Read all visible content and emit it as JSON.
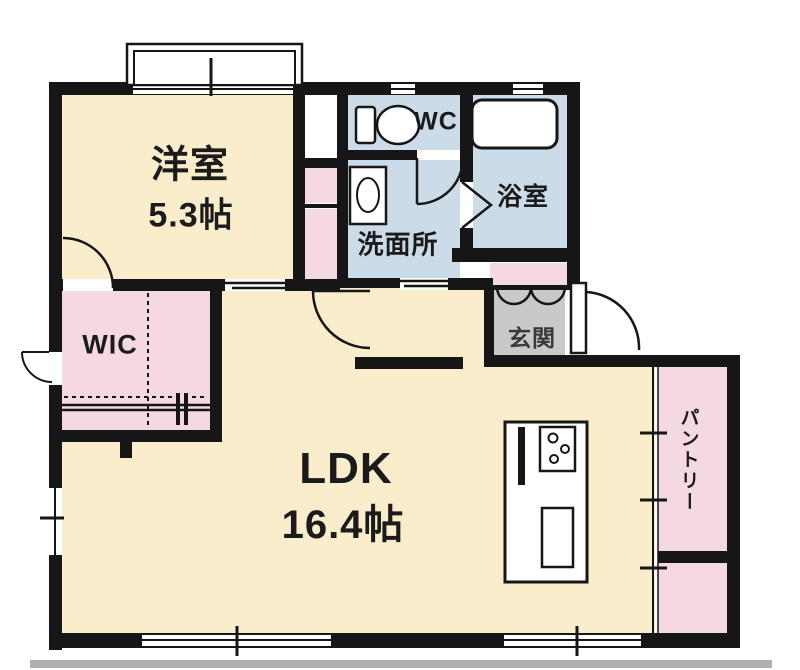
{
  "plan_title": "floor-plan",
  "rooms": {
    "western_room": {
      "label": "洋室",
      "area": "5.3帖"
    },
    "wc": {
      "label": "WC"
    },
    "washroom": {
      "label": "洗面所"
    },
    "bathroom": {
      "label": "浴室"
    },
    "entrance": {
      "label": "玄関"
    },
    "wic": {
      "label": "WIC"
    },
    "ldk": {
      "label": "LDK",
      "area": "16.4帖"
    },
    "pantry": {
      "label": "パントリー"
    }
  },
  "icons": [
    "toilet-icon",
    "sink-icon",
    "bathtub-icon",
    "stove-icon",
    "kitchen-sink-icon",
    "kitchen-counter-icon",
    "hanger-icon",
    "door-swing-arc",
    "double-door-arcs",
    "folding-door-icon",
    "sliding-door-icon",
    "window-symbol"
  ],
  "colors": {
    "cream": "#FAEDCB",
    "pink": "#F5D9E2",
    "blue": "#CBDBE7",
    "gray": "#C9C9C9",
    "wall": "#161616",
    "bar": "#AFAFB1"
  }
}
